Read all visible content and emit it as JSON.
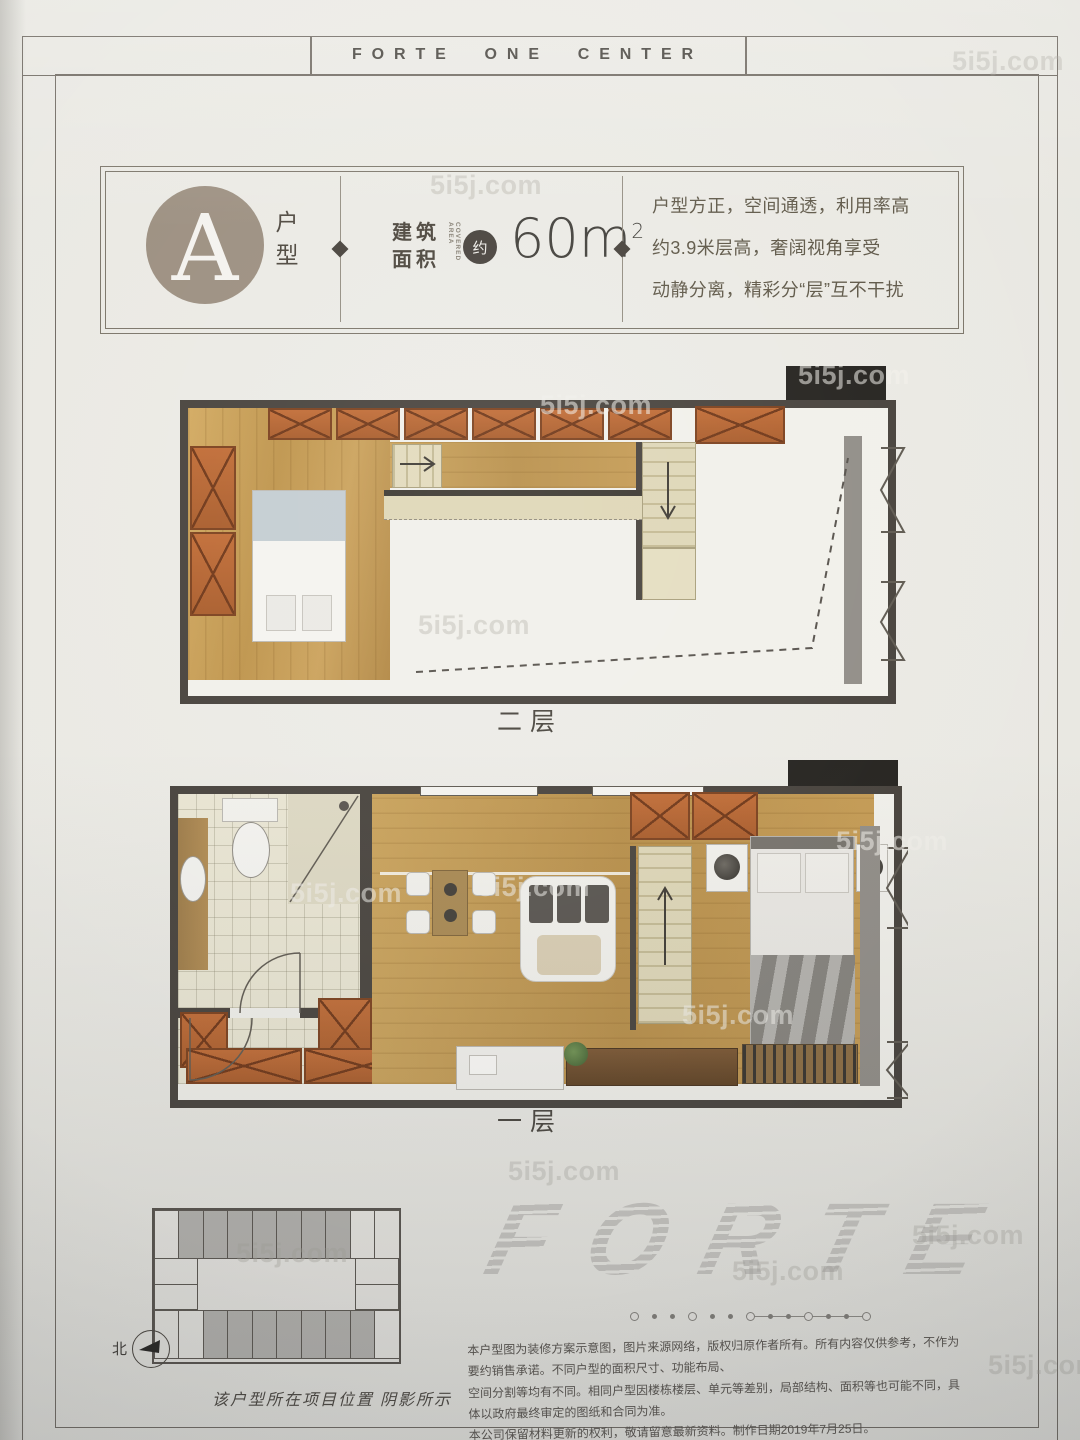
{
  "photo_watermark": "5i5j.com",
  "header": {
    "title": "FORTE ONE CENTER"
  },
  "unit": {
    "letter": "A",
    "type_label": "户型",
    "area_label_cn": [
      "建筑",
      "面积"
    ],
    "area_label_en": "COVERED AREA",
    "approx": "约",
    "area_value": "60m",
    "area_exponent": "2",
    "features": [
      "户型方正，空间通透，利用率高",
      "约3.9米层高，奢阔视角享受",
      "动静分离，精彩分“层”互不干扰"
    ]
  },
  "floors": {
    "second": "二层",
    "first": "一层"
  },
  "site_plan": {
    "north_label": "北",
    "caption": "该户型所在项目位置 阴影所示",
    "top_row_cells": 10,
    "bottom_row_cells": 10,
    "top_shaded": [
      2,
      3,
      4,
      5,
      6,
      7,
      8
    ],
    "bottom_shaded": [
      3,
      4,
      5,
      6,
      7,
      8,
      9
    ]
  },
  "brand": {
    "logo": "FORTE"
  },
  "decor_dots": {
    "plain": [
      "ring",
      "dot",
      "dot",
      "ring",
      "dot",
      "dot"
    ],
    "linked": [
      "ring",
      "dot",
      "dot",
      "ring",
      "dot",
      "dot",
      "ring"
    ]
  },
  "disclaimer": [
    "本户型图为装修方案示意图，图片来源网络，版权归原作者所有。所有内容仅供参考，不作为要约销售承诺。不同户型的面积尺寸、功能布局、",
    "空间分割等均有不同。相同户型因楼栋楼层、单元等差别，局部结构、面积等也可能不同，具体以政府最终审定的图纸和合同为准。",
    "本公司保留材料更新的权利，敬请留意最新资料。制作日期2019年7月25日。"
  ],
  "colors": {
    "badge_taupe": "#9b8e7f",
    "wall": "#45403a",
    "wood": "#c19a55",
    "cabinet": "#b5622f",
    "paper": "#e9e7e1"
  }
}
